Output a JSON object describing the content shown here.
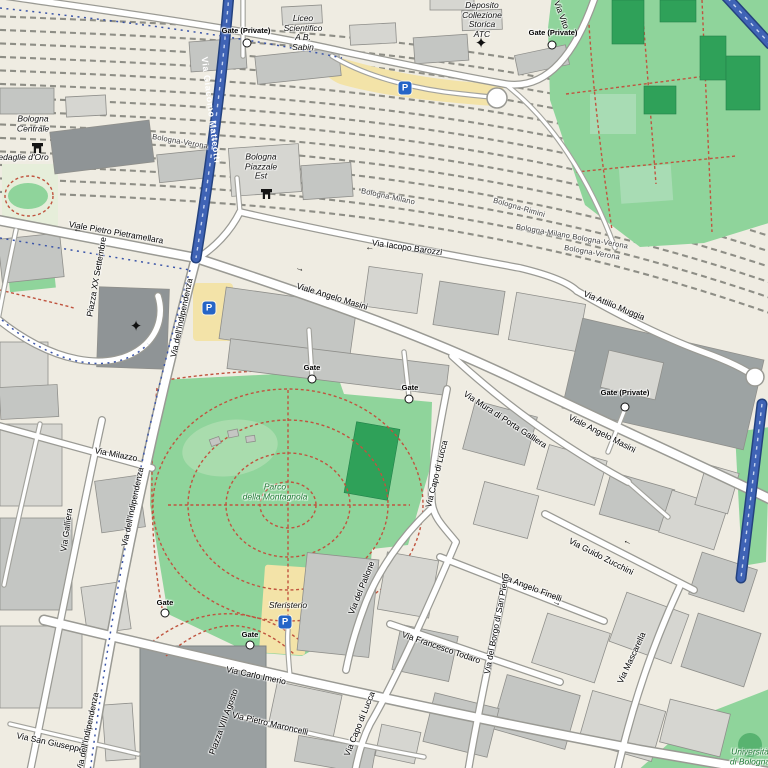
{
  "map": {
    "region": "Bologna city centre / stazione area",
    "colors": {
      "background": "#efece2",
      "road_fill": "#ffffff",
      "road_casing": "#9a9a94",
      "blue_road": "#3f63b5",
      "park_green": "#8fd49b",
      "dark_green": "#2fa159",
      "building": "#c4c6c3",
      "building_dark": "#8f9496",
      "plaza": "#9aa0a1",
      "parking_yellow": "#f3e3a8",
      "route_red": "#c0543f",
      "route_blue": "#3b55a8",
      "rail_track": "#8e8e86",
      "parking_icon_blue": "#2565c7"
    },
    "icons": {
      "parking_letter": "P",
      "star_glyph": "✦",
      "gate_marker": "white-circle",
      "station_glyph": "station-building"
    },
    "street_labels": [
      {
        "text": "Viale Pietro Pietramellara",
        "x": 116,
        "y": 233,
        "rot": 10
      },
      {
        "text": "Via Giacomo Matteotti",
        "x": 211,
        "y": 110,
        "rot": 83,
        "on_blue": true
      },
      {
        "text": "Piazza XX Settembre",
        "x": 97,
        "y": 277,
        "rot": -80
      },
      {
        "text": "Via dell'Indipendenza",
        "x": 182,
        "y": 318,
        "rot": -78
      },
      {
        "text": "Viale Angelo Masini",
        "x": 332,
        "y": 297,
        "rot": 17
      },
      {
        "text": "Via Iacopo Barozzi",
        "x": 407,
        "y": 248,
        "rot": 8
      },
      {
        "text": "Via Attilio Muggia",
        "x": 614,
        "y": 306,
        "rot": 22
      },
      {
        "text": "Viale Angelo Masini",
        "x": 602,
        "y": 434,
        "rot": 27
      },
      {
        "text": "Via Mura di Porta Galliera",
        "x": 505,
        "y": 420,
        "rot": 33
      },
      {
        "text": "Via Capo di Lucca",
        "x": 437,
        "y": 474,
        "rot": -76
      },
      {
        "text": "Via Milazzo",
        "x": 116,
        "y": 455,
        "rot": 11
      },
      {
        "text": "Via Galliera",
        "x": 67,
        "y": 530,
        "rot": -82
      },
      {
        "text": "Via dell'Indipendenza",
        "x": 133,
        "y": 507,
        "rot": -78
      },
      {
        "text": "Via del Pallone",
        "x": 362,
        "y": 588,
        "rot": -68
      },
      {
        "text": "Via Guido Zucchini",
        "x": 601,
        "y": 557,
        "rot": 27
      },
      {
        "text": "Via Angelo Finelli",
        "x": 531,
        "y": 588,
        "rot": 21
      },
      {
        "text": "Via del Borgo di San Pietro",
        "x": 497,
        "y": 624,
        "rot": -79
      },
      {
        "text": "Via Francesco Todaro",
        "x": 441,
        "y": 648,
        "rot": 19
      },
      {
        "text": "Via Mascarella",
        "x": 632,
        "y": 658,
        "rot": -65
      },
      {
        "text": "Via Carlo Imerio",
        "x": 256,
        "y": 676,
        "rot": 12
      },
      {
        "text": "Via Pietro Maroncelli",
        "x": 270,
        "y": 724,
        "rot": 13
      },
      {
        "text": "Via Capo di Lucca",
        "x": 360,
        "y": 724,
        "rot": -68
      },
      {
        "text": "Via San Giuseppe",
        "x": 50,
        "y": 743,
        "rot": 12
      },
      {
        "text": "Piazza VIII Agosto",
        "x": 224,
        "y": 722,
        "rot": -70
      },
      {
        "text": "Via dell'Indipendenza",
        "x": 88,
        "y": 732,
        "rot": -78
      },
      {
        "text": "Via Vito",
        "x": 561,
        "y": 15,
        "rot": 70
      }
    ],
    "rail_labels": [
      {
        "text": "Bologna-Verona",
        "x": 180,
        "y": 142,
        "rot": 10
      },
      {
        "text": "Bologna-Milano",
        "x": 388,
        "y": 197,
        "rot": 12
      },
      {
        "text": "Bologna-Rimini",
        "x": 519,
        "y": 208,
        "rot": 16
      },
      {
        "text": "Bologna-Milano Bologna-Verona",
        "x": 572,
        "y": 237,
        "rot": 10
      },
      {
        "text": "Bologna-Verona",
        "x": 592,
        "y": 253,
        "rot": 10
      }
    ],
    "place_labels": [
      {
        "text": "Bologna\nCentrale",
        "x": 33,
        "y": 124,
        "green": false
      },
      {
        "text": "Medaglie d'Oro",
        "x": 20,
        "y": 158,
        "green": false
      },
      {
        "text": "Bologna\nPiazzale\nEst",
        "x": 261,
        "y": 167,
        "green": false
      },
      {
        "text": "Liceo\nScientifico\nA B.\nSabin",
        "x": 303,
        "y": 33,
        "green": false
      },
      {
        "text": "Deposito\nCollezione\nStorica\nATC",
        "x": 482,
        "y": 20,
        "green": false
      },
      {
        "text": "Parco\ndella Montagnola",
        "x": 275,
        "y": 492,
        "green": true
      },
      {
        "text": "Sferisterio",
        "x": 288,
        "y": 606,
        "green": false
      },
      {
        "text": "Università\ndi Bologna",
        "x": 750,
        "y": 757,
        "green": true
      }
    ],
    "gates": [
      {
        "text": "Gate (Private)",
        "x": 246,
        "y": 31,
        "cx": 247,
        "cy": 43
      },
      {
        "text": "Gate (Private)",
        "x": 553,
        "y": 33,
        "cx": 552,
        "cy": 45
      },
      {
        "text": "Gate (Private)",
        "x": 625,
        "y": 393,
        "cx": 625,
        "cy": 407
      },
      {
        "text": "Gate",
        "x": 312,
        "y": 368,
        "cx": 312,
        "cy": 379
      },
      {
        "text": "Gate",
        "x": 410,
        "y": 388,
        "cx": 409,
        "cy": 399
      },
      {
        "text": "Gate",
        "x": 165,
        "y": 603,
        "cx": 165,
        "cy": 613
      },
      {
        "text": "Gate",
        "x": 250,
        "y": 635,
        "cx": 250,
        "cy": 645
      }
    ],
    "parking_icons": [
      {
        "x": 405,
        "y": 88
      },
      {
        "x": 209,
        "y": 308
      },
      {
        "x": 285,
        "y": 622
      }
    ],
    "station_icons": [
      {
        "x": 31,
        "y": 142
      },
      {
        "x": 260,
        "y": 188
      }
    ],
    "star_icons": [
      {
        "x": 481,
        "y": 43
      },
      {
        "x": 136,
        "y": 326
      }
    ],
    "arrows": [
      {
        "glyph": "←",
        "x": 78,
        "y": 229,
        "rot": 10
      },
      {
        "glyph": "←",
        "x": 370,
        "y": 247,
        "rot": 8
      },
      {
        "glyph": "→",
        "x": 300,
        "y": 268,
        "rot": 16
      },
      {
        "glyph": "←",
        "x": 628,
        "y": 541,
        "rot": 25
      },
      {
        "glyph": "→",
        "x": 557,
        "y": 602,
        "rot": 22
      }
    ]
  }
}
